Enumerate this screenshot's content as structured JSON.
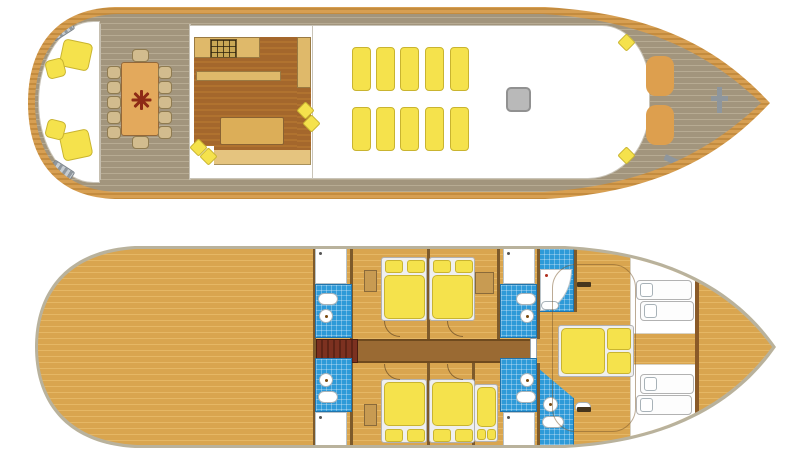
{
  "meta": {
    "kind": "yacht-deck-plan",
    "decks": [
      {
        "id": "upper-deck",
        "label": "upper-deck-plan"
      },
      {
        "id": "lower-deck",
        "label": "lower-deck-plan"
      }
    ]
  },
  "colors": {
    "rim-a": "#d79f52",
    "rim-b": "#c48c3f",
    "deck-a": "#a2957d",
    "deck-b": "#b7ab93",
    "wood-a": "#d9a54f",
    "wood-b": "#e5b765",
    "hull-edge": "#b9b29c",
    "outline": "#c9c4b8",
    "yellow": "#f5e24c",
    "yellow-br": "#c9b430",
    "galley-a": "#a4672c",
    "galley-b": "#b0722f",
    "counter": "#dfb96a",
    "counter-br": "#9a7a42",
    "table": "#e3a95c",
    "table-br": "#93683a",
    "compass": "#8e2b16",
    "chair": "#d2bc8e",
    "chair-br": "#8f7b50",
    "hatch": "#b9b9b9",
    "hatch-br": "#919191",
    "sunpad": "#dd9f4e",
    "steel": "#8e969d",
    "corridor": "#9a6a33",
    "corridor-br": "#6f4a1e",
    "stair-a": "#7c3120",
    "stair-b": "#5e2416",
    "tile": "#2e9ad8",
    "tile-line": "rgba(255,255,255,0.3)",
    "tile-br": "#1f74ad",
    "fixture-br": "#a8b2b8",
    "wall": "#7d5a2b",
    "bedframe": "#efefef",
    "bedframe-br": "#b2b2b2"
  },
  "upper_deck": {
    "aft_cockpit": {
      "armchairs": [
        {
          "x": 61,
          "y": 41,
          "w": 30,
          "h": 28,
          "r": 12
        },
        {
          "x": 46,
          "y": 59,
          "w": 19,
          "h": 19,
          "r": -14
        },
        {
          "x": 61,
          "y": 131,
          "w": 30,
          "h": 28,
          "r": -12
        },
        {
          "x": 46,
          "y": 120,
          "w": 19,
          "h": 19,
          "r": 14
        }
      ],
      "boarding_steps": [
        {
          "x": 50,
          "y": 24,
          "r": -33
        },
        {
          "x": 50,
          "y": 165,
          "r": 33
        }
      ]
    },
    "dining": {
      "table": {
        "x": 121,
        "y": 62,
        "w": 38,
        "h": 74
      },
      "compass_rose": true,
      "seat_count": 12,
      "side_chair_ys": [
        66,
        81,
        96,
        111,
        126
      ],
      "left_chair_x": 107,
      "right_chair_x": 158,
      "end_chairs": [
        {
          "x": 132,
          "y": 49
        },
        {
          "x": 132,
          "y": 136
        }
      ]
    },
    "galley": {
      "cushions": [
        {
          "x": 299,
          "y": 104
        },
        {
          "x": 305,
          "y": 117
        },
        {
          "x": 192,
          "y": 141
        },
        {
          "x": 202,
          "y": 150
        }
      ]
    },
    "saloon": {
      "mat_count": 10,
      "mat_cols_x": [
        352,
        376,
        400,
        425,
        450
      ],
      "mat_rows_y": [
        47,
        107
      ],
      "mat_w": 19,
      "mat_h": 44,
      "hatch": {
        "x": 506,
        "y": 87,
        "w": 25,
        "h": 25
      }
    },
    "foredeck": {
      "sunpads": [
        {
          "x": 646,
          "y": 56
        },
        {
          "x": 646,
          "y": 105
        }
      ],
      "sunpad_w": 28,
      "sunpad_h": 40,
      "cushions": [
        {
          "x": 620,
          "y": 36
        },
        {
          "x": 620,
          "y": 149
        }
      ],
      "cleats": [
        {
          "x": 664,
          "y": 29,
          "r": -25
        },
        {
          "x": 664,
          "y": 157,
          "r": 25
        }
      ]
    }
  },
  "lower_deck": {
    "stairs": {
      "x": 316,
      "y": 339,
      "w": 42,
      "h": 24
    },
    "corridor": {
      "x": 316,
      "y": 339,
      "w": 219,
      "h": 24
    },
    "guest_cabin_count": 4,
    "guest_beds": [
      {
        "x": 381,
        "y": 257,
        "flip": false
      },
      {
        "x": 429,
        "y": 257,
        "flip": false
      },
      {
        "x": 381,
        "y": 379,
        "flip": true
      },
      {
        "x": 429,
        "y": 379,
        "flip": true
      }
    ],
    "single_bed": {
      "x": 474,
      "y": 384,
      "w": 24,
      "h": 58
    },
    "bathrooms": [
      {
        "x": 315,
        "y": 248,
        "pos": "top",
        "side": "left"
      },
      {
        "x": 500,
        "y": 248,
        "pos": "top",
        "side": "right"
      },
      {
        "x": 315,
        "y": 358,
        "pos": "bottom",
        "side": "left"
      },
      {
        "x": 500,
        "y": 358,
        "pos": "bottom",
        "side": "right"
      }
    ],
    "nightstands": [
      {
        "x": 364,
        "y": 270,
        "w": 13,
        "h": 22
      },
      {
        "x": 475,
        "y": 272,
        "w": 19,
        "h": 22
      },
      {
        "x": 364,
        "y": 404,
        "w": 13,
        "h": 22
      }
    ],
    "door_arcs": [
      {
        "x": 384,
        "y": 321
      },
      {
        "x": 447,
        "y": 321
      },
      {
        "x": 384,
        "y": 364
      },
      {
        "x": 447,
        "y": 364
      }
    ],
    "bunk_count": 4,
    "bunks": [
      {
        "x": 636,
        "y": 280,
        "w": 56
      },
      {
        "x": 640,
        "y": 301,
        "w": 54
      },
      {
        "x": 640,
        "y": 374,
        "w": 54
      },
      {
        "x": 636,
        "y": 395,
        "w": 56
      }
    ],
    "walls": [
      {
        "x": 313,
        "y": 246,
        "h": 202
      },
      {
        "x": 350,
        "y": 246,
        "h": 93
      },
      {
        "x": 350,
        "y": 363,
        "h": 85
      },
      {
        "x": 427,
        "y": 246,
        "h": 93
      },
      {
        "x": 427,
        "y": 363,
        "h": 85
      },
      {
        "x": 497,
        "y": 246,
        "h": 93
      },
      {
        "x": 472,
        "y": 363,
        "h": 85
      },
      {
        "x": 537,
        "y": 246,
        "h": 93
      },
      {
        "x": 537,
        "y": 363,
        "h": 85
      },
      {
        "x": 574,
        "y": 246,
        "h": 66
      }
    ]
  }
}
